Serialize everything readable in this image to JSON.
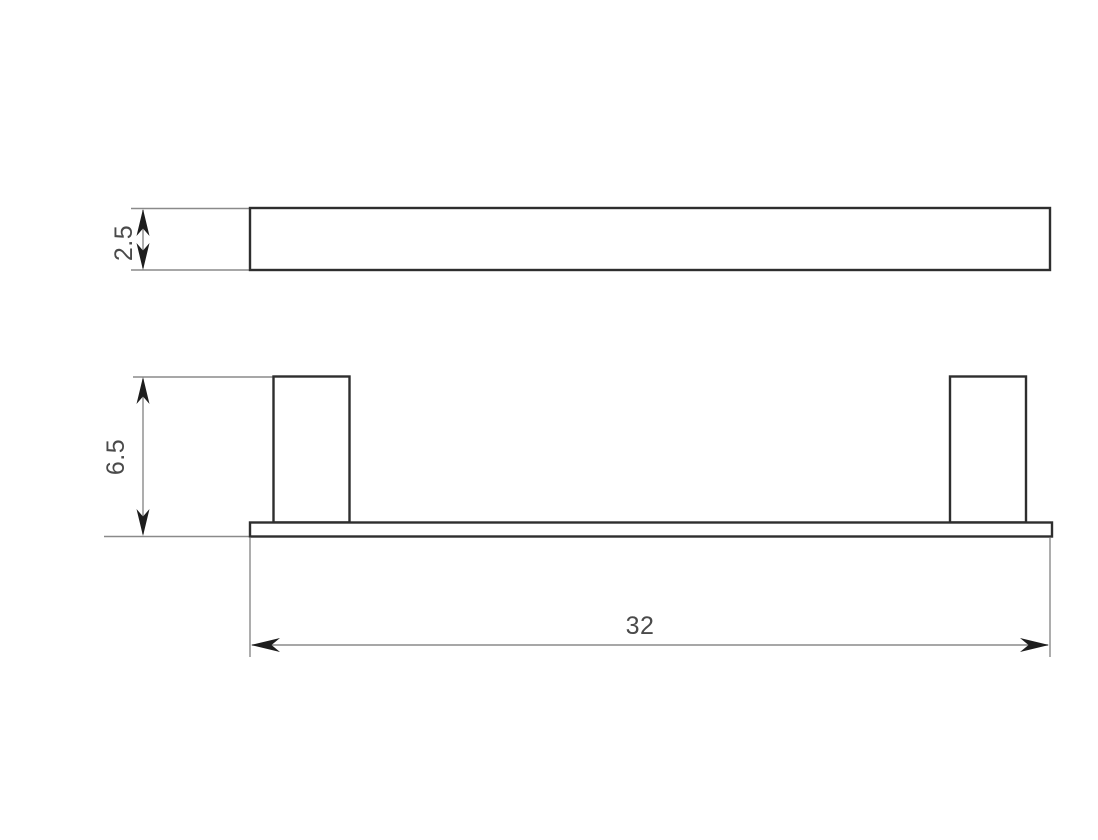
{
  "drawing": {
    "dimensions": {
      "top_view_thickness": "2.5",
      "front_view_height": "6.5",
      "front_view_width": "32"
    },
    "colors": {
      "background": "#ffffff",
      "outline": "#2e2e2e",
      "dimension_line": "#8a8a8a",
      "arrow": "#1d1d1d",
      "text": "#4a4a4a"
    }
  }
}
